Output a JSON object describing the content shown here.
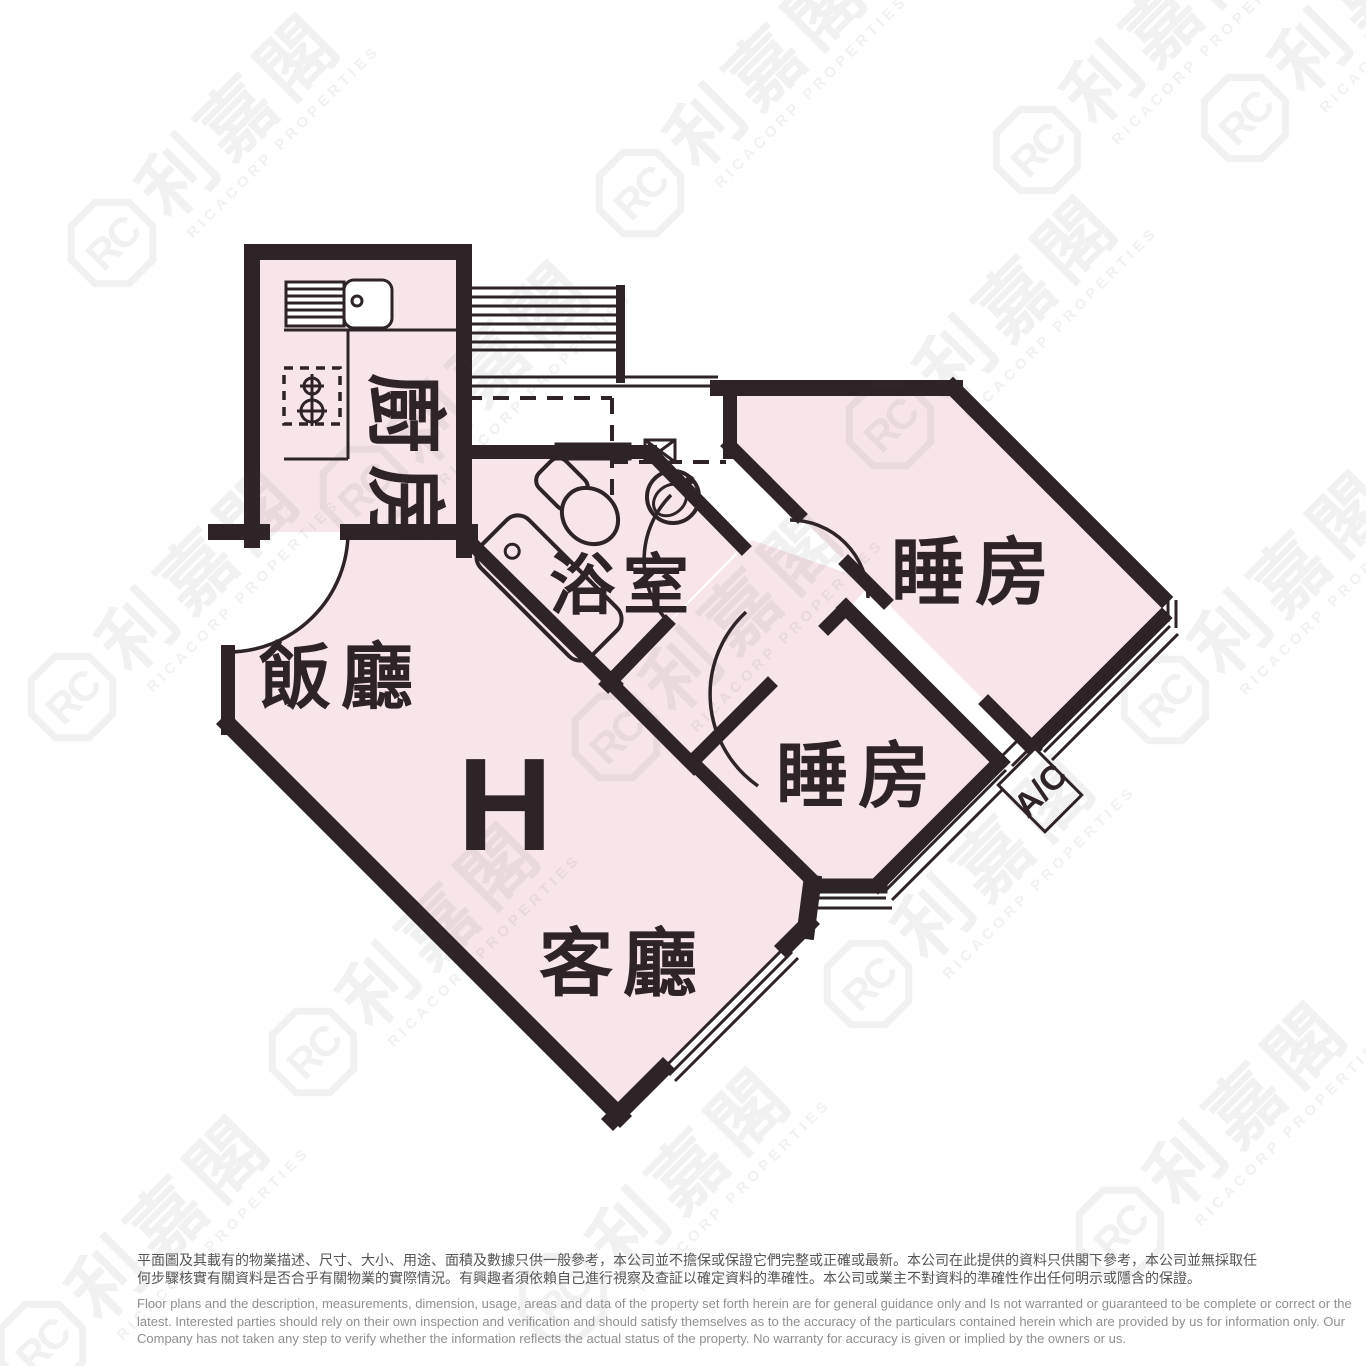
{
  "floorplan": {
    "unit_label": "H",
    "labels": {
      "kitchen": "廚房",
      "bathroom": "浴室",
      "dining": "飯廳",
      "living": "客廳",
      "bedroom_top": "睡房",
      "bedroom_mid": "睡房",
      "ac": "A/C"
    },
    "colors": {
      "wall": "#2e2326",
      "room_fill": "#f8e5e9"
    }
  },
  "watermark": {
    "logo_initials": "RC",
    "brand_cn": "利嘉閣",
    "brand_en": "RICACORP PROPERTIES"
  },
  "disclaimer": {
    "zh_line1": "平面圖及其載有的物業描述、尺寸、大小、用途、面積及數據只供一般參考，本公司並不擔保或保證它們完整或正確或最新。本公司在此提供的資料只供閣下參考，本公司並無採取任",
    "zh_line2": "何步驟核實有關資料是否合乎有關物業的實際情況。有興趣者須依賴自己進行視察及查証以確定資料的準確性。本公司或業主不對資料的準確性作出任何明示或隱含的保證。",
    "en_line1": "Floor plans and the description, measurements, dimension, usage, areas and data of the property set forth herein are for general guidance only and Is not warranted or guaranteed to be complete or correct or the",
    "en_line2": "latest. Interested parties should rely on their own inspection and verification and should satisfy themselves as to the accuracy of the particulars contained herein which are provided by us for information only.  Our",
    "en_line3": "Company has not taken any step to verify whether the information reflects the actual status of the property.  No warranty for accuracy is given or implied by the owners or us."
  }
}
